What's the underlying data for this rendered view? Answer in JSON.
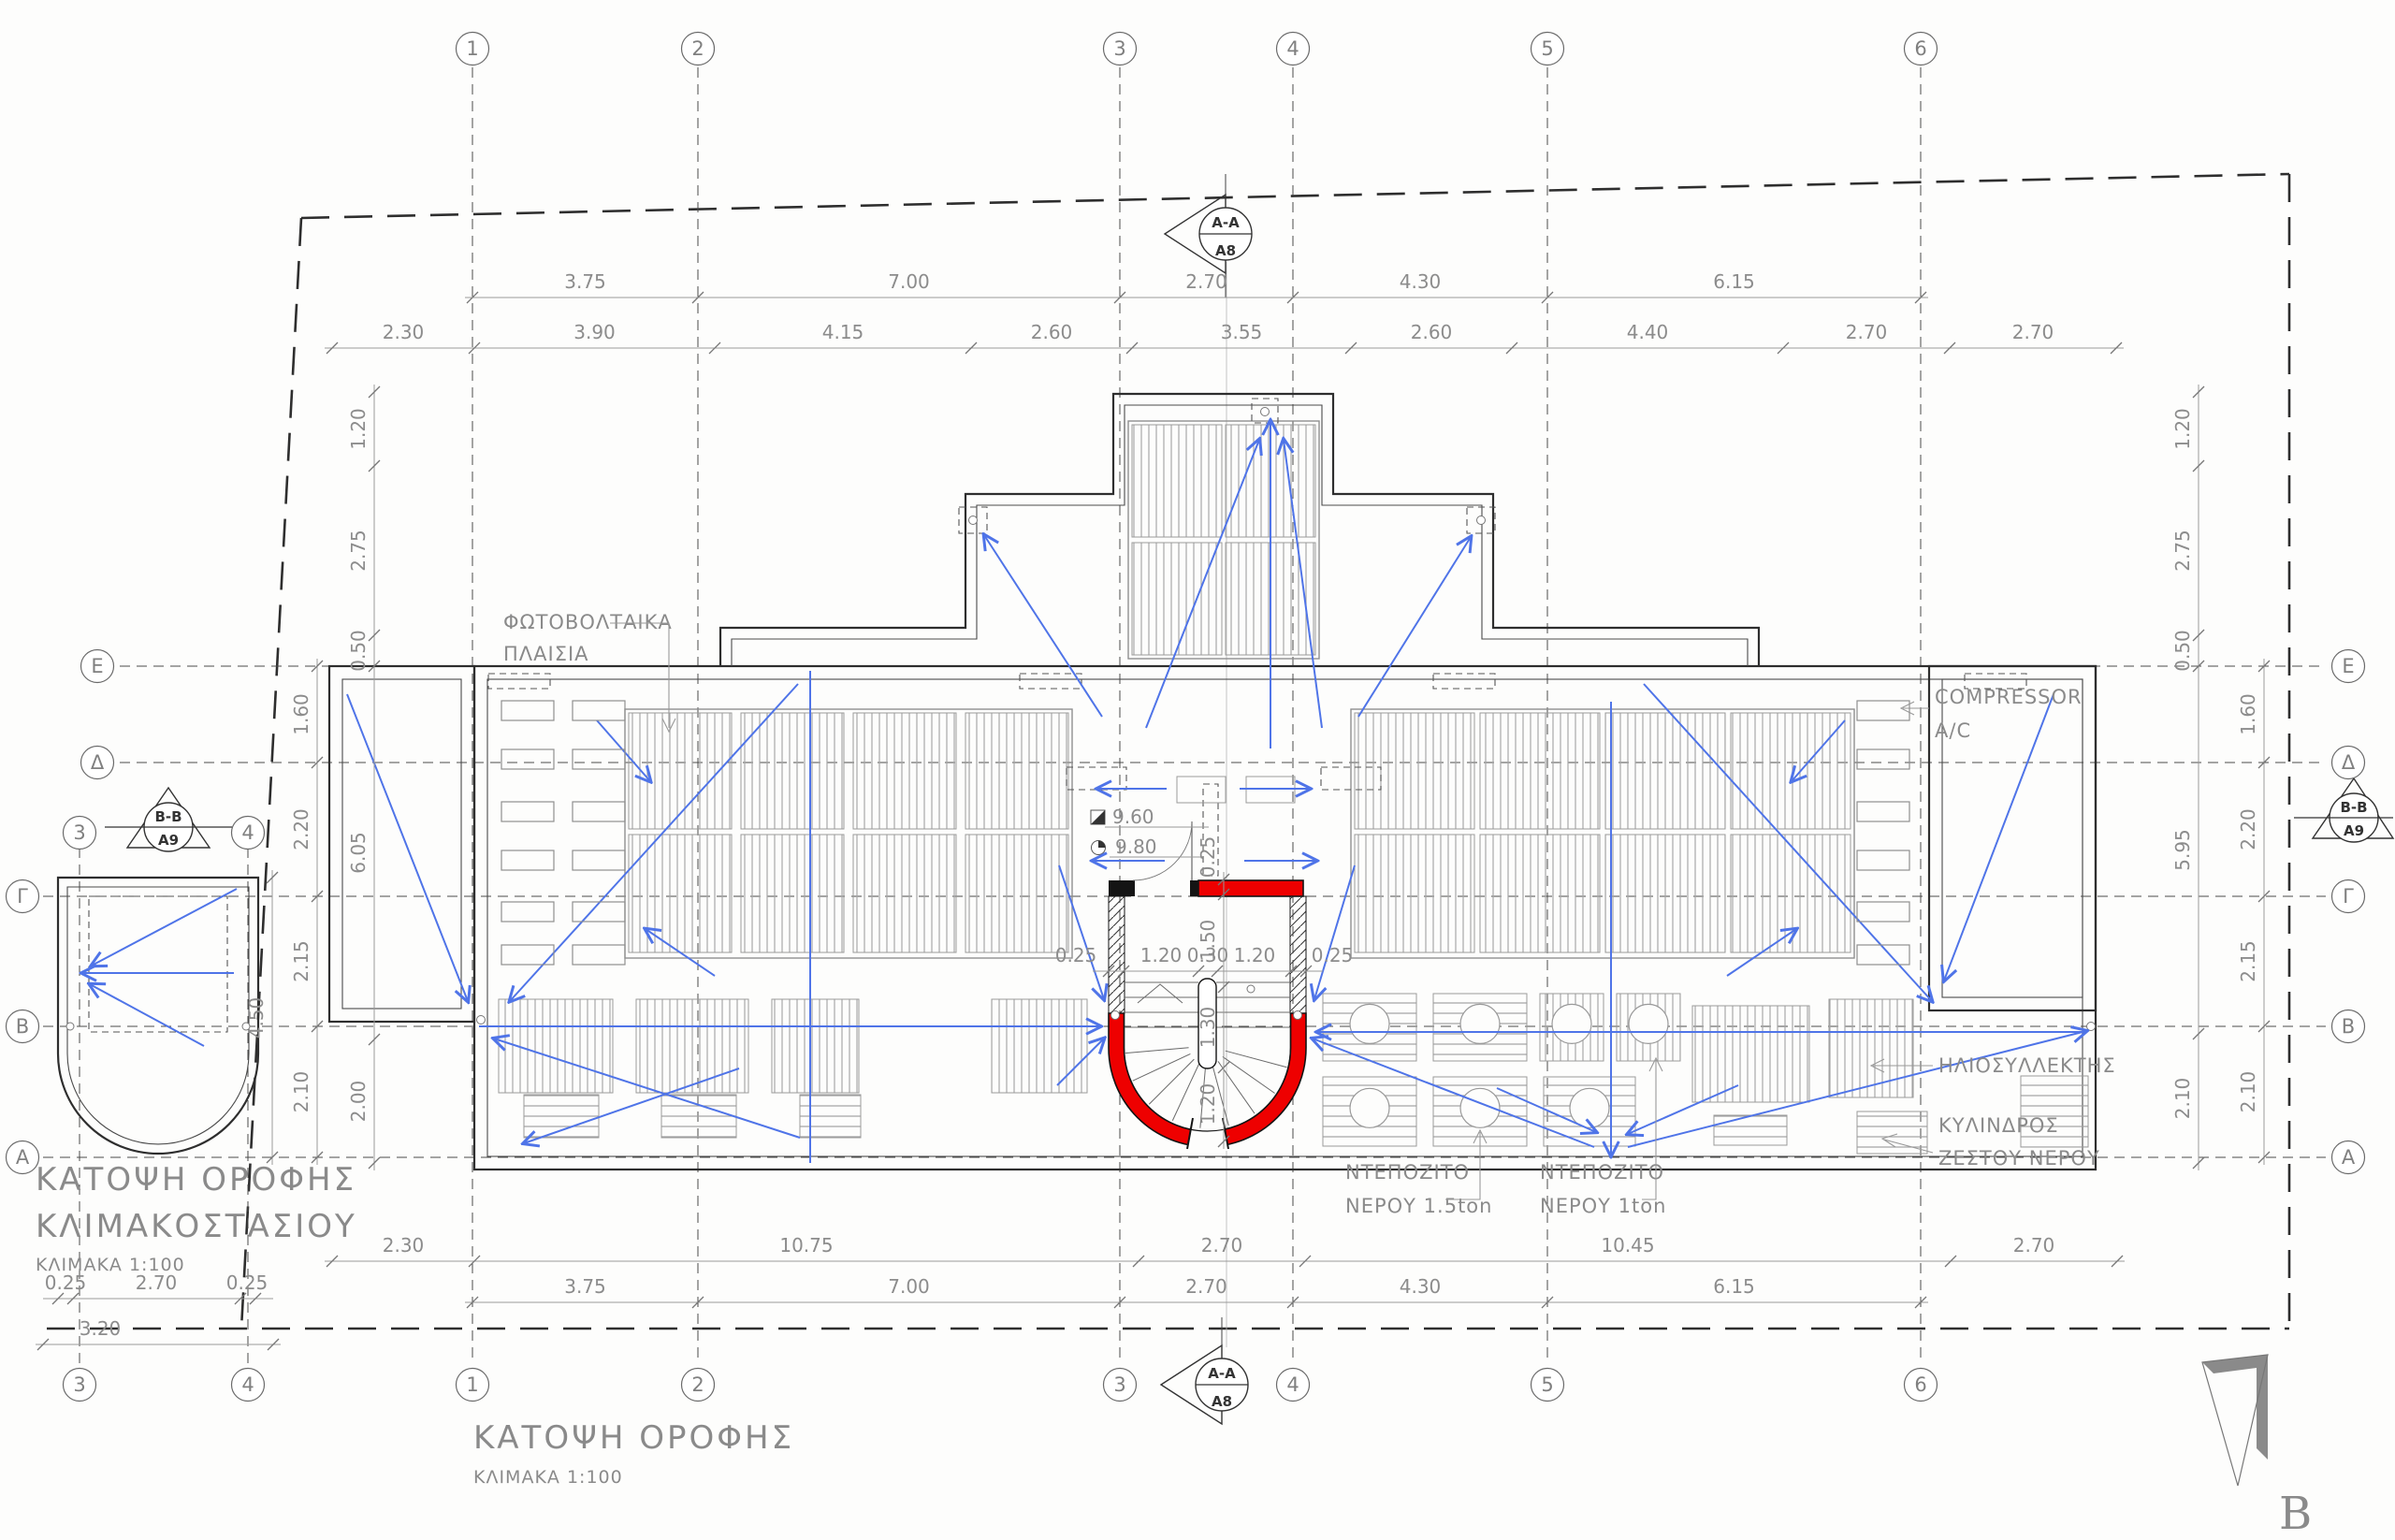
{
  "drawing": {
    "titles": {
      "main": "ΚΑΤΟΨΗ ΟΡΟΦΗΣ",
      "main_scale": "ΚΛΙΜΑΚΑ 1:100",
      "detail_line1": "ΚΑΤΟΨΗ ΟΡΟΦΗΣ",
      "detail_line2": "ΚΛΙΜΑΚΟΣΤΑΣΙΟΥ",
      "detail_scale": "ΚΛΙΜΑΚΑ 1:100"
    },
    "north_label": "Β",
    "grid": {
      "cols": [
        "1",
        "2",
        "3",
        "4",
        "5",
        "6"
      ],
      "rows": [
        "Ε",
        "Δ",
        "Γ",
        "Β",
        "Α"
      ],
      "detail_cols": [
        "3",
        "4"
      ]
    },
    "sections": {
      "aa": {
        "name": "A-A",
        "sheet": "A8"
      },
      "bb": {
        "name": "B-B",
        "sheet": "A9"
      }
    },
    "labels": {
      "pv1": "ΦΩΤΟΒΟΛΤΑΙΚΑ",
      "pv2": "ΠΛΑΙΣΙΑ",
      "compressor1": "COMPRESSOR",
      "compressor2": "A/C",
      "solar": "ΗΛΙΟΣΥΛΛΕΚΤΗΣ",
      "cyl1": "ΚΥΛΙΝΔΡΟΣ",
      "cyl2": "ΖΕΣΤΟΥ ΝΕΡΟΥ",
      "tank15_1": "ΝΤΕΠΟΖΙΤΟ",
      "tank15_2": "ΝΕΡΟΥ 1.5ton",
      "tank10_1": "ΝΤΕΠΟΖΙΤΟ",
      "tank10_2": "ΝΕΡΟΥ 1ton"
    },
    "levels": {
      "upper": "9.60",
      "lower": "9.80"
    },
    "dims": {
      "top1": [
        "3.75",
        "7.00",
        "2.70",
        "4.30",
        "6.15"
      ],
      "top2": [
        "2.30",
        "3.90",
        "4.15",
        "2.60",
        "3.55",
        "2.60",
        "4.40",
        "2.70",
        "2.70"
      ],
      "bottom1": [
        "2.30",
        "10.75",
        "2.70",
        "10.45",
        "2.70"
      ],
      "bottom2": [
        "3.75",
        "7.00",
        "2.70",
        "4.30",
        "6.15"
      ],
      "left_inner": [
        "1.20",
        "2.75",
        "0.50",
        "6.05",
        "2.00"
      ],
      "right_inner": [
        "1.20",
        "2.75",
        "0.50",
        "5.95",
        "2.10"
      ],
      "right_outer": [
        "1.60",
        "2.20",
        "2.15",
        "2.10"
      ],
      "left_outer": [
        "1.60",
        "2.20",
        "2.15",
        "2.10"
      ],
      "detail_height": "4.50",
      "detail_bottom": [
        "0.25",
        "2.70",
        "0.25"
      ],
      "detail_total": "3.20",
      "stair_h": [
        "0.25",
        "1.20",
        "0.30",
        "1.20",
        "0.25"
      ],
      "stair_v": [
        "0.25",
        "1.50",
        "1.30",
        "1.20"
      ]
    },
    "colors": {
      "red": "#ee0000",
      "blue": "#4f74e8",
      "line": "#2e2e2e",
      "dim": "#8c8c8c"
    }
  }
}
